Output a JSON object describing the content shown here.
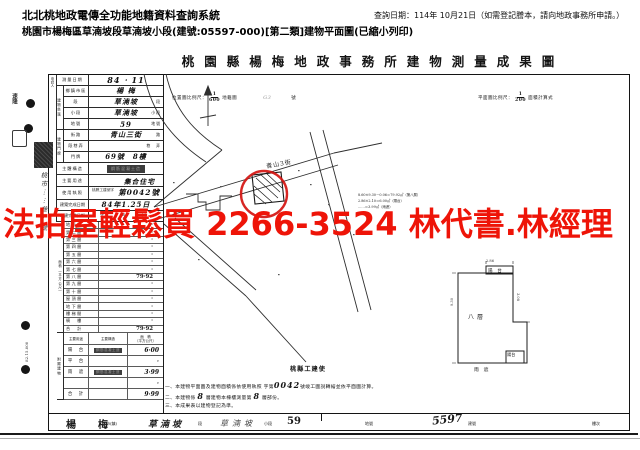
{
  "header": {
    "system_title": "北北桃地政電傳全功能地籍資料查詢系統",
    "query_date_note": "查詢日期：114年 10月21日（如需登記謄本，請向地政事務所申請。）",
    "subtitle": "桃園市楊梅區草湳坡段草湳坡小段(建號:05597-000)[第二類]建物平面圖(已縮小列印)"
  },
  "watermark": {
    "text": "法拍屋輕鬆買 2266-3524 林代書.林經理",
    "color": "#ee1408"
  },
  "sheet": {
    "title": "桃園縣楊梅地政事務所建物測量成果圖",
    "location_scale": {
      "label": "位置圖比例尺：",
      "num": "1",
      "den": "600",
      "suffix": "地籍圖",
      "pencil": "G3",
      "sheet_word": "號"
    },
    "plan_scale": {
      "label": "平面圖比例尺：",
      "num": "1",
      "den": "200",
      "suffix": "面積計算式"
    },
    "applicant_label": "申請人",
    "survey_date": {
      "label": "測量日期",
      "value": "84 ‧ 11"
    },
    "section_location": "建物坐落",
    "section_door": "建物門牌",
    "main_rows": [
      {
        "label": "鄉鎮市區",
        "value": "楊 梅",
        "unit": ""
      },
      {
        "label": "段",
        "value": "草湳坡",
        "unit": "段"
      },
      {
        "label": "小段",
        "value": "草湳坡",
        "unit": "小段"
      },
      {
        "label": "地號",
        "value": "59",
        "unit": "地號"
      },
      {
        "label": "街路",
        "value": "青山三街",
        "unit": "路"
      },
      {
        "label": "段巷弄",
        "value": "",
        "unit": "巷　弄"
      },
      {
        "label": "門牌",
        "value": "69號　8樓",
        "unit": ""
      }
    ],
    "structure": {
      "label": "主體構造",
      "stamp": "鋼筋混凝土造"
    },
    "usage": {
      "label": "主要用途",
      "value": "集合住宅"
    },
    "license": {
      "label": "使用執照",
      "small": "桃縣工建使字",
      "big": "第0042號"
    },
    "completed": {
      "label": "建築完成日期",
      "value": "84年1.25日"
    },
    "extension": {
      "label": "增建完成日期",
      "value": "年　月　日"
    },
    "section_area": "面積（平方公尺）",
    "floor_rows": [
      {
        "label": "地面層",
        "value": "·"
      },
      {
        "label": "第二層",
        "value": "·"
      },
      {
        "label": "第三層",
        "value": "·"
      },
      {
        "label": "第四層",
        "value": "·"
      },
      {
        "label": "第五層",
        "value": "·"
      },
      {
        "label": "第六層",
        "value": "·"
      },
      {
        "label": "第七層",
        "value": "·"
      },
      {
        "label": "第八層",
        "value": "79·92"
      },
      {
        "label": "第九層",
        "value": "·"
      },
      {
        "label": "第十層",
        "value": "·"
      },
      {
        "label": "屋頂層",
        "value": "·"
      },
      {
        "label": "地下層",
        "value": "·"
      },
      {
        "label": "樓梯間",
        "value": "·"
      },
      {
        "label": "騎　樓",
        "value": "·"
      },
      {
        "label": "合　計",
        "value": "79·92"
      }
    ],
    "section_annex": "附屬建物",
    "annex_header": {
      "usage": "主要用途",
      "structure": "主要構造",
      "area": "面　積",
      "area2": "（平方公尺）"
    },
    "annex_rows": [
      {
        "usage": "陽　台",
        "structure": "鋼筋混凝土造",
        "area": "6·00"
      },
      {
        "usage": "平　台",
        "structure": "",
        "area": "·"
      },
      {
        "usage": "雨　遮",
        "structure": "鋼筋混凝土造",
        "area": "3·99"
      },
      {
        "usage": "",
        "structure": "",
        "area": "·"
      },
      {
        "usage": "合　計",
        "structure": "",
        "area": "9·99"
      }
    ],
    "map": {
      "street": "青山3街",
      "calc_lines": [
        "8.60×9.30－0.06＝79.92㎡（第八層）",
        "2.86×2.10＝6.00㎡（陽台）",
        "……＝3.99㎡（雨遮）"
      ]
    },
    "plan": {
      "floor": "八層",
      "balcony_top": "陽　台",
      "balcony_bottom": "陽台",
      "canopy": "雨　遮",
      "dim_top": "2.86",
      "dim_left": "9.30",
      "dim_right": "3.08"
    },
    "notes": {
      "heading": "桃縣工建使",
      "l1a": "一、本建物平面圖及建物面積係依使用執照",
      "l1b": "字第",
      "l1no": "0042",
      "l1c": "號竣工圖說轉繪並依平面圖計算。",
      "l2a": "二、本建物係",
      "l2n1": "8",
      "l2b": "層建物本棟樓測量第",
      "l2n2": "8",
      "l2c": "層部份。",
      "l3": "三、本成果表以建物登記為準。"
    },
    "margin": {
      "stamp": "速隆",
      "address": "桃市⋯⋯巷7號",
      "print_code": "82.15.000"
    },
    "footer": {
      "city": "楊　梅",
      "city_u": "市(鎮)",
      "sec": "草湳坡",
      "sec_u": "段",
      "subsec": "草湳坡",
      "subsec_u": "小段",
      "parcel": "59",
      "parcel_u": "地號",
      "bno": "5597",
      "bno_u": "建號",
      "floor_u": "樓次"
    }
  }
}
